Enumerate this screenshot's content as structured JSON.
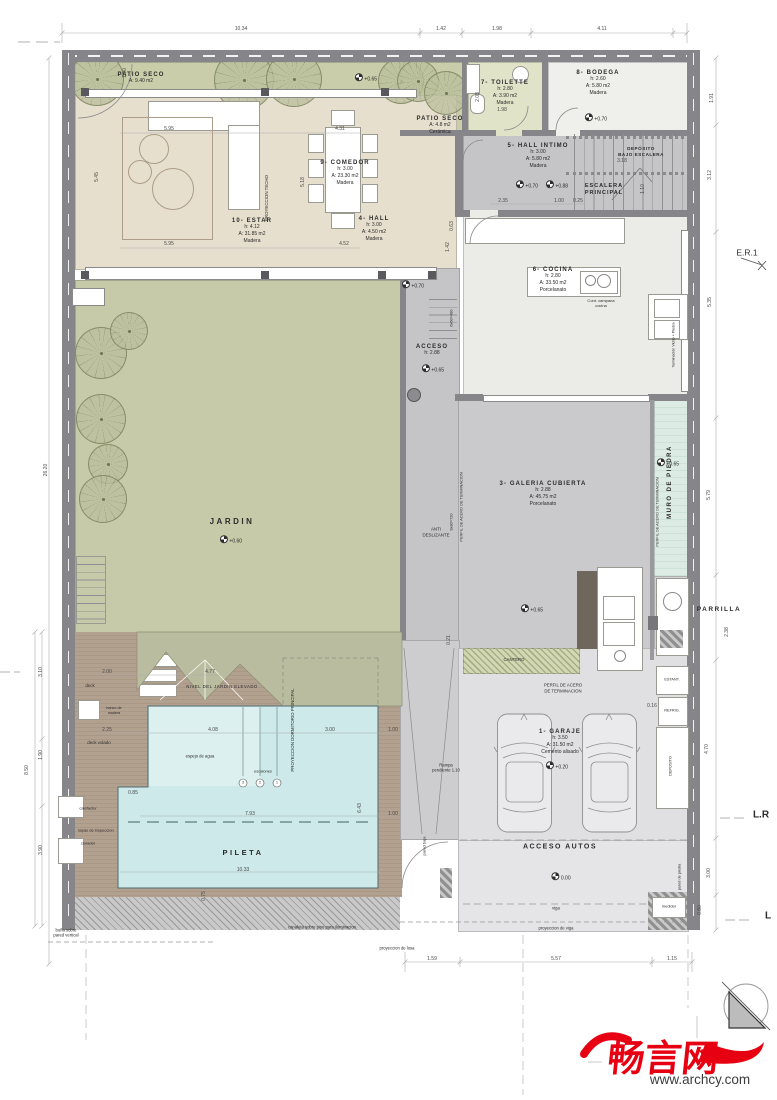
{
  "palette": {
    "wall": "#85858a",
    "garden": "#c6caa8",
    "patio": "#c9cda9",
    "living": "#e7dfce",
    "gray_floor": "#c5c5c7",
    "cocina": "#ebebe7",
    "pool": "#cde9e9",
    "deck": "#b3a190",
    "stone_wall": "#dcebe3",
    "accent_red": "#e60012"
  },
  "watermark": {
    "logo": "畅言网",
    "site": "www.archcy.com"
  },
  "rooms": [
    {
      "id": "patio-seco-1",
      "name": "PATIO SECO",
      "lines": [
        "A: 9.40 m2"
      ],
      "x": 141,
      "y": 72
    },
    {
      "id": "estar",
      "name": "10- ESTAR",
      "lines": [
        "h: 4.12",
        "A: 31.85 m2",
        "Madera"
      ],
      "x": 252,
      "y": 218
    },
    {
      "id": "comedor",
      "name": "9- COMEDOR",
      "lines": [
        "h: 3.00",
        "A: 23.30 m2",
        "Madera"
      ],
      "x": 345,
      "y": 160
    },
    {
      "id": "hall",
      "name": "4- HALL",
      "lines": [
        "h: 3.00",
        "A: 4.50 m2",
        "Madera"
      ],
      "x": 374,
      "y": 216
    },
    {
      "id": "toilette",
      "name": "7- TOILETTE",
      "lines": [
        "h: 2.80",
        "A: 3.90 m2",
        "Madera"
      ],
      "x": 505,
      "y": 80
    },
    {
      "id": "bodega",
      "name": "8- BODEGA",
      "lines": [
        "h: 2.60",
        "A: 5.80 m2",
        "Madera"
      ],
      "x": 598,
      "y": 70
    },
    {
      "id": "patio-seco-2",
      "name": "PATIO SECO",
      "lines": [
        "A: 4.8 m2",
        "Cerámica"
      ],
      "x": 440,
      "y": 116
    },
    {
      "id": "hall-intimo",
      "name": "5- HALL INTIMO",
      "lines": [
        "h: 3.00",
        "A: 5.80 m2",
        "Madera"
      ],
      "x": 538,
      "y": 143
    },
    {
      "id": "cocina",
      "name": "6- COCINA",
      "lines": [
        "h: 2.80",
        "A: 33.50 m2",
        "Porcelanato"
      ],
      "x": 553,
      "y": 267
    },
    {
      "id": "galeria",
      "name": "3- GALERIA CUBIERTA",
      "lines": [
        "h: 2.88",
        "A: 45.75 m2",
        "Porcelanato"
      ],
      "x": 543,
      "y": 481
    },
    {
      "id": "garaje",
      "name": "1- GARAJE",
      "lines": [
        "h: 3.50",
        "A: 31.50 m2",
        "Cemento alisado"
      ],
      "x": 560,
      "y": 729
    },
    {
      "id": "acceso",
      "name": "ACCESO",
      "lines": [
        "h: 2.88"
      ],
      "x": 432,
      "y": 344
    }
  ],
  "labels": [
    {
      "id": "jardin",
      "t": "JARDIN",
      "x": 232,
      "y": 522,
      "s": 8,
      "b": 1,
      "ls": 2.5
    },
    {
      "id": "pileta",
      "t": "PILETA",
      "x": 243,
      "y": 853,
      "s": 7.5,
      "b": 1,
      "ls": 2.5
    },
    {
      "id": "acceso-autos",
      "t": "ACCESO AUTOS",
      "x": 560,
      "y": 847,
      "s": 7,
      "b": 1,
      "ls": 1.5
    },
    {
      "id": "parrilla",
      "t": "PARRILLA",
      "x": 719,
      "y": 610,
      "s": 6.5,
      "b": 1,
      "ls": 1.5
    },
    {
      "id": "muro-de-piedra",
      "t": "MURO DE PIEDRA",
      "x": 671,
      "y": 482,
      "s": 6,
      "b": 1,
      "ls": 1.5,
      "r": 1
    },
    {
      "id": "escalera-principal",
      "t": "ESCALERA\nPRINCIPAL",
      "x": 604,
      "y": 190,
      "s": 5.5,
      "b": 1,
      "ls": 1
    },
    {
      "id": "deposito-bajo-escalera",
      "t": "DEPÓSITO\nBAJO ESCALERA",
      "x": 641,
      "y": 152,
      "s": 4.6,
      "b": 1,
      "ls": 0.5
    },
    {
      "id": "nivel-jardin-elevado",
      "t": "NIVEL DEL JARDIN ELEVADO",
      "x": 222,
      "y": 687,
      "s": 4.3,
      "ls": 0.5
    },
    {
      "id": "cantero",
      "t": "CANTERO",
      "x": 514,
      "y": 660,
      "s": 4.3
    },
    {
      "id": "proyeccion-techo",
      "t": "PROYECCION TECHO",
      "x": 267,
      "y": 198,
      "s": 4.4,
      "r": 1
    },
    {
      "id": "proyeccion-dormitorio",
      "t": "PROYECCION DORMITORIO PRINCIPAL",
      "x": 293,
      "y": 730,
      "s": 4.4,
      "r": 1
    },
    {
      "id": "perfil-acero-1",
      "t": "PERFIL DE ACERO DE TERMINACION",
      "x": 461,
      "y": 507,
      "s": 3.9,
      "r": 1
    },
    {
      "id": "perfil-acero-2",
      "t": "PERFIL DE ACERO DE TERMINACION",
      "x": 657,
      "y": 512,
      "s": 3.9,
      "r": 1
    },
    {
      "id": "perfil-acero-3",
      "t": "PERFIL DE ACERO\nDE TERMINACION",
      "x": 563,
      "y": 688,
      "s": 4.3
    },
    {
      "id": "terminacion-vidrio",
      "t": "Terminación Vidrio + Piedra",
      "x": 674,
      "y": 345,
      "s": 3.7,
      "r": 1
    },
    {
      "id": "anti-deslizante",
      "t": "ANTI\nDESLIZANTE",
      "x": 436,
      "y": 532,
      "s": 4.4
    },
    {
      "id": "campana-cocina",
      "t": "Cont. campana\ncocina",
      "x": 601,
      "y": 303,
      "s": 4
    },
    {
      "id": "deck",
      "t": "deck",
      "x": 90,
      "y": 686,
      "s": 4.4
    },
    {
      "id": "banco-de-madera",
      "t": "banco de\nmadera",
      "x": 114,
      "y": 711,
      "s": 3.7
    },
    {
      "id": "deck-volado",
      "t": "deck volado",
      "x": 99,
      "y": 743,
      "s": 4.4
    },
    {
      "id": "calefactor",
      "t": "calefactor",
      "x": 88,
      "y": 808,
      "s": 4
    },
    {
      "id": "tapas-inspeccion",
      "t": "tapas de inspeccion",
      "x": 96,
      "y": 830,
      "s": 4
    },
    {
      "id": "clorador",
      "t": "clorador",
      "x": 88,
      "y": 843,
      "s": 4
    },
    {
      "id": "espejo-de-agua",
      "t": "espejo de agua",
      "x": 200,
      "y": 756,
      "s": 4.2
    },
    {
      "id": "escalones",
      "t": "escalones",
      "x": 263,
      "y": 771,
      "s": 4
    },
    {
      "id": "esc-num-3",
      "t": "3",
      "x": 243,
      "y": 783,
      "s": 3.6
    },
    {
      "id": "esc-num-2",
      "t": "2",
      "x": 260,
      "y": 783,
      "s": 3.6
    },
    {
      "id": "esc-num-1",
      "t": "1",
      "x": 277,
      "y": 783,
      "s": 3.6
    },
    {
      "id": "rampa",
      "t": "Rampa\npendiente 1.10",
      "x": 446,
      "y": 768,
      "s": 4.2
    },
    {
      "id": "pared-baja",
      "t": "pared baja",
      "x": 424,
      "y": 846,
      "s": 4,
      "r": 1
    },
    {
      "id": "pared-de-piedra",
      "t": "pared de piedra",
      "x": 680,
      "y": 877,
      "s": 3.8,
      "r": 1
    },
    {
      "id": "medidor",
      "t": "medidor",
      "x": 669,
      "y": 906,
      "s": 4
    },
    {
      "id": "viga",
      "t": "viga",
      "x": 556,
      "y": 908,
      "s": 4.2
    },
    {
      "id": "proyeccion-viga",
      "t": "proyeccion de viga",
      "x": 556,
      "y": 928,
      "s": 4.2
    },
    {
      "id": "proyeccion-losa",
      "t": "proyeccion de losa",
      "x": 397,
      "y": 948,
      "s": 4.2
    },
    {
      "id": "canaleta",
      "t": "canaleta sobre piso para iluminacion",
      "x": 322,
      "y": 927,
      "s": 4.2
    },
    {
      "id": "buna-pared",
      "t": "buña sobre\npared vertical",
      "x": 66,
      "y": 933,
      "s": 4.2
    },
    {
      "id": "estant",
      "t": "ESTANT.",
      "x": 672,
      "y": 680,
      "s": 3.8
    },
    {
      "id": "refrig",
      "t": "REFRIG.",
      "x": 672,
      "y": 711,
      "s": 3.8
    },
    {
      "id": "deposito",
      "t": "DEPOSITO",
      "x": 671,
      "y": 766,
      "s": 3.8,
      "r": 1
    },
    {
      "id": "er1",
      "t": "E.R.1",
      "x": 747,
      "y": 253,
      "s": 8.5
    },
    {
      "id": "lr",
      "t": "L.R",
      "x": 761,
      "y": 815,
      "s": 10,
      "b": 1
    },
    {
      "id": "l",
      "t": "L",
      "x": 768,
      "y": 916,
      "s": 10,
      "b": 1
    },
    {
      "id": "esc-6x60",
      "t": "6x60=480",
      "x": 451,
      "y": 318,
      "s": 3.9,
      "r": 1
    },
    {
      "id": "esc-9x80",
      "t": "9x80=720",
      "x": 451,
      "y": 522,
      "s": 3.9,
      "r": 1
    }
  ],
  "levels": [
    {
      "id": "lvl-patio",
      "v": "+0.65",
      "x": 366,
      "y": 78
    },
    {
      "id": "lvl-bodega",
      "v": "+0.70",
      "x": 596,
      "y": 118
    },
    {
      "id": "lvl-hallintimo-a",
      "v": "+0.70",
      "x": 527,
      "y": 185
    },
    {
      "id": "lvl-hallintimo-b",
      "v": "+0.88",
      "x": 557,
      "y": 185
    },
    {
      "id": "lvl-corredor",
      "v": "+0.70",
      "x": 413,
      "y": 285
    },
    {
      "id": "lvl-acceso",
      "v": "+0.65",
      "x": 433,
      "y": 369
    },
    {
      "id": "lvl-galeria",
      "v": "+0.65",
      "x": 532,
      "y": 609
    },
    {
      "id": "lvl-muro",
      "v": "+0.65",
      "x": 668,
      "y": 463
    },
    {
      "id": "lvl-jardin",
      "v": "+0.60",
      "x": 231,
      "y": 540
    },
    {
      "id": "lvl-garaje",
      "v": "+0.20",
      "x": 557,
      "y": 766
    },
    {
      "id": "lvl-acceso-autos",
      "v": "0.00",
      "x": 561,
      "y": 877
    }
  ],
  "dims": [
    {
      "v": "10.34",
      "x": 241,
      "y": 29
    },
    {
      "v": "1.42",
      "x": 441,
      "y": 29
    },
    {
      "v": "1.98",
      "x": 497,
      "y": 29
    },
    {
      "v": "4.11",
      "x": 602,
      "y": 29
    },
    {
      "v": "26.20",
      "x": 46,
      "y": 470,
      "r": 1
    },
    {
      "v": "3.10",
      "x": 41,
      "y": 672,
      "r": 1
    },
    {
      "v": "1.90",
      "x": 41,
      "y": 755,
      "r": 1
    },
    {
      "v": "8.50",
      "x": 27,
      "y": 770,
      "r": 1
    },
    {
      "v": "3.90",
      "x": 41,
      "y": 850,
      "r": 1
    },
    {
      "v": "1.91",
      "x": 712,
      "y": 98,
      "r": 1
    },
    {
      "v": "3.12",
      "x": 710,
      "y": 175,
      "r": 1
    },
    {
      "v": "5.35",
      "x": 710,
      "y": 302,
      "r": 1
    },
    {
      "v": "5.79",
      "x": 709,
      "y": 495,
      "r": 1
    },
    {
      "v": "2.38",
      "x": 727,
      "y": 632,
      "r": 1
    },
    {
      "v": "4.70",
      "x": 707,
      "y": 749,
      "r": 1
    },
    {
      "v": "3.00",
      "x": 709,
      "y": 873,
      "r": 1
    },
    {
      "v": "0.80",
      "x": 700,
      "y": 910,
      "r": 1
    },
    {
      "v": "0.16",
      "x": 652,
      "y": 706
    },
    {
      "v": "1.59",
      "x": 432,
      "y": 959
    },
    {
      "v": "5.57",
      "x": 556,
      "y": 959
    },
    {
      "v": "1.15",
      "x": 672,
      "y": 959
    },
    {
      "v": "5.95",
      "x": 169,
      "y": 129
    },
    {
      "v": "5.95",
      "x": 169,
      "y": 244
    },
    {
      "v": "5.45",
      "x": 97,
      "y": 177,
      "r": 1
    },
    {
      "v": "5.18",
      "x": 303,
      "y": 182,
      "r": 1
    },
    {
      "v": "4.31",
      "x": 340,
      "y": 129
    },
    {
      "v": "4.52",
      "x": 344,
      "y": 244
    },
    {
      "v": "1.00",
      "x": 125,
      "y": 73,
      "r": 1
    },
    {
      "v": "1.98",
      "x": 502,
      "y": 110
    },
    {
      "v": "2.03",
      "x": 478,
      "y": 97,
      "r": 1
    },
    {
      "v": "2.35",
      "x": 503,
      "y": 201
    },
    {
      "v": "1.00",
      "x": 559,
      "y": 201
    },
    {
      "v": "0.25",
      "x": 578,
      "y": 201
    },
    {
      "v": "1.10",
      "x": 643,
      "y": 189,
      "r": 1
    },
    {
      "v": "0.63",
      "x": 452,
      "y": 226,
      "r": 1
    },
    {
      "v": "3.18",
      "x": 622,
      "y": 161
    },
    {
      "v": "1.42",
      "x": 448,
      "y": 247,
      "r": 1
    },
    {
      "v": "0.21",
      "x": 449,
      "y": 640,
      "r": 1
    },
    {
      "v": "2.00",
      "x": 107,
      "y": 672
    },
    {
      "v": "4.77",
      "x": 210,
      "y": 672
    },
    {
      "v": "2.25",
      "x": 107,
      "y": 730
    },
    {
      "v": "4.08",
      "x": 213,
      "y": 730
    },
    {
      "v": "3.00",
      "x": 330,
      "y": 730
    },
    {
      "v": "1.00",
      "x": 393,
      "y": 730
    },
    {
      "v": "0.85",
      "x": 133,
      "y": 793
    },
    {
      "v": "7.93",
      "x": 250,
      "y": 814
    },
    {
      "v": "6.43",
      "x": 360,
      "y": 808,
      "r": 1
    },
    {
      "v": "1.00",
      "x": 393,
      "y": 814
    },
    {
      "v": "10.33",
      "x": 243,
      "y": 870
    },
    {
      "v": "0.75",
      "x": 204,
      "y": 896,
      "r": 1
    }
  ]
}
